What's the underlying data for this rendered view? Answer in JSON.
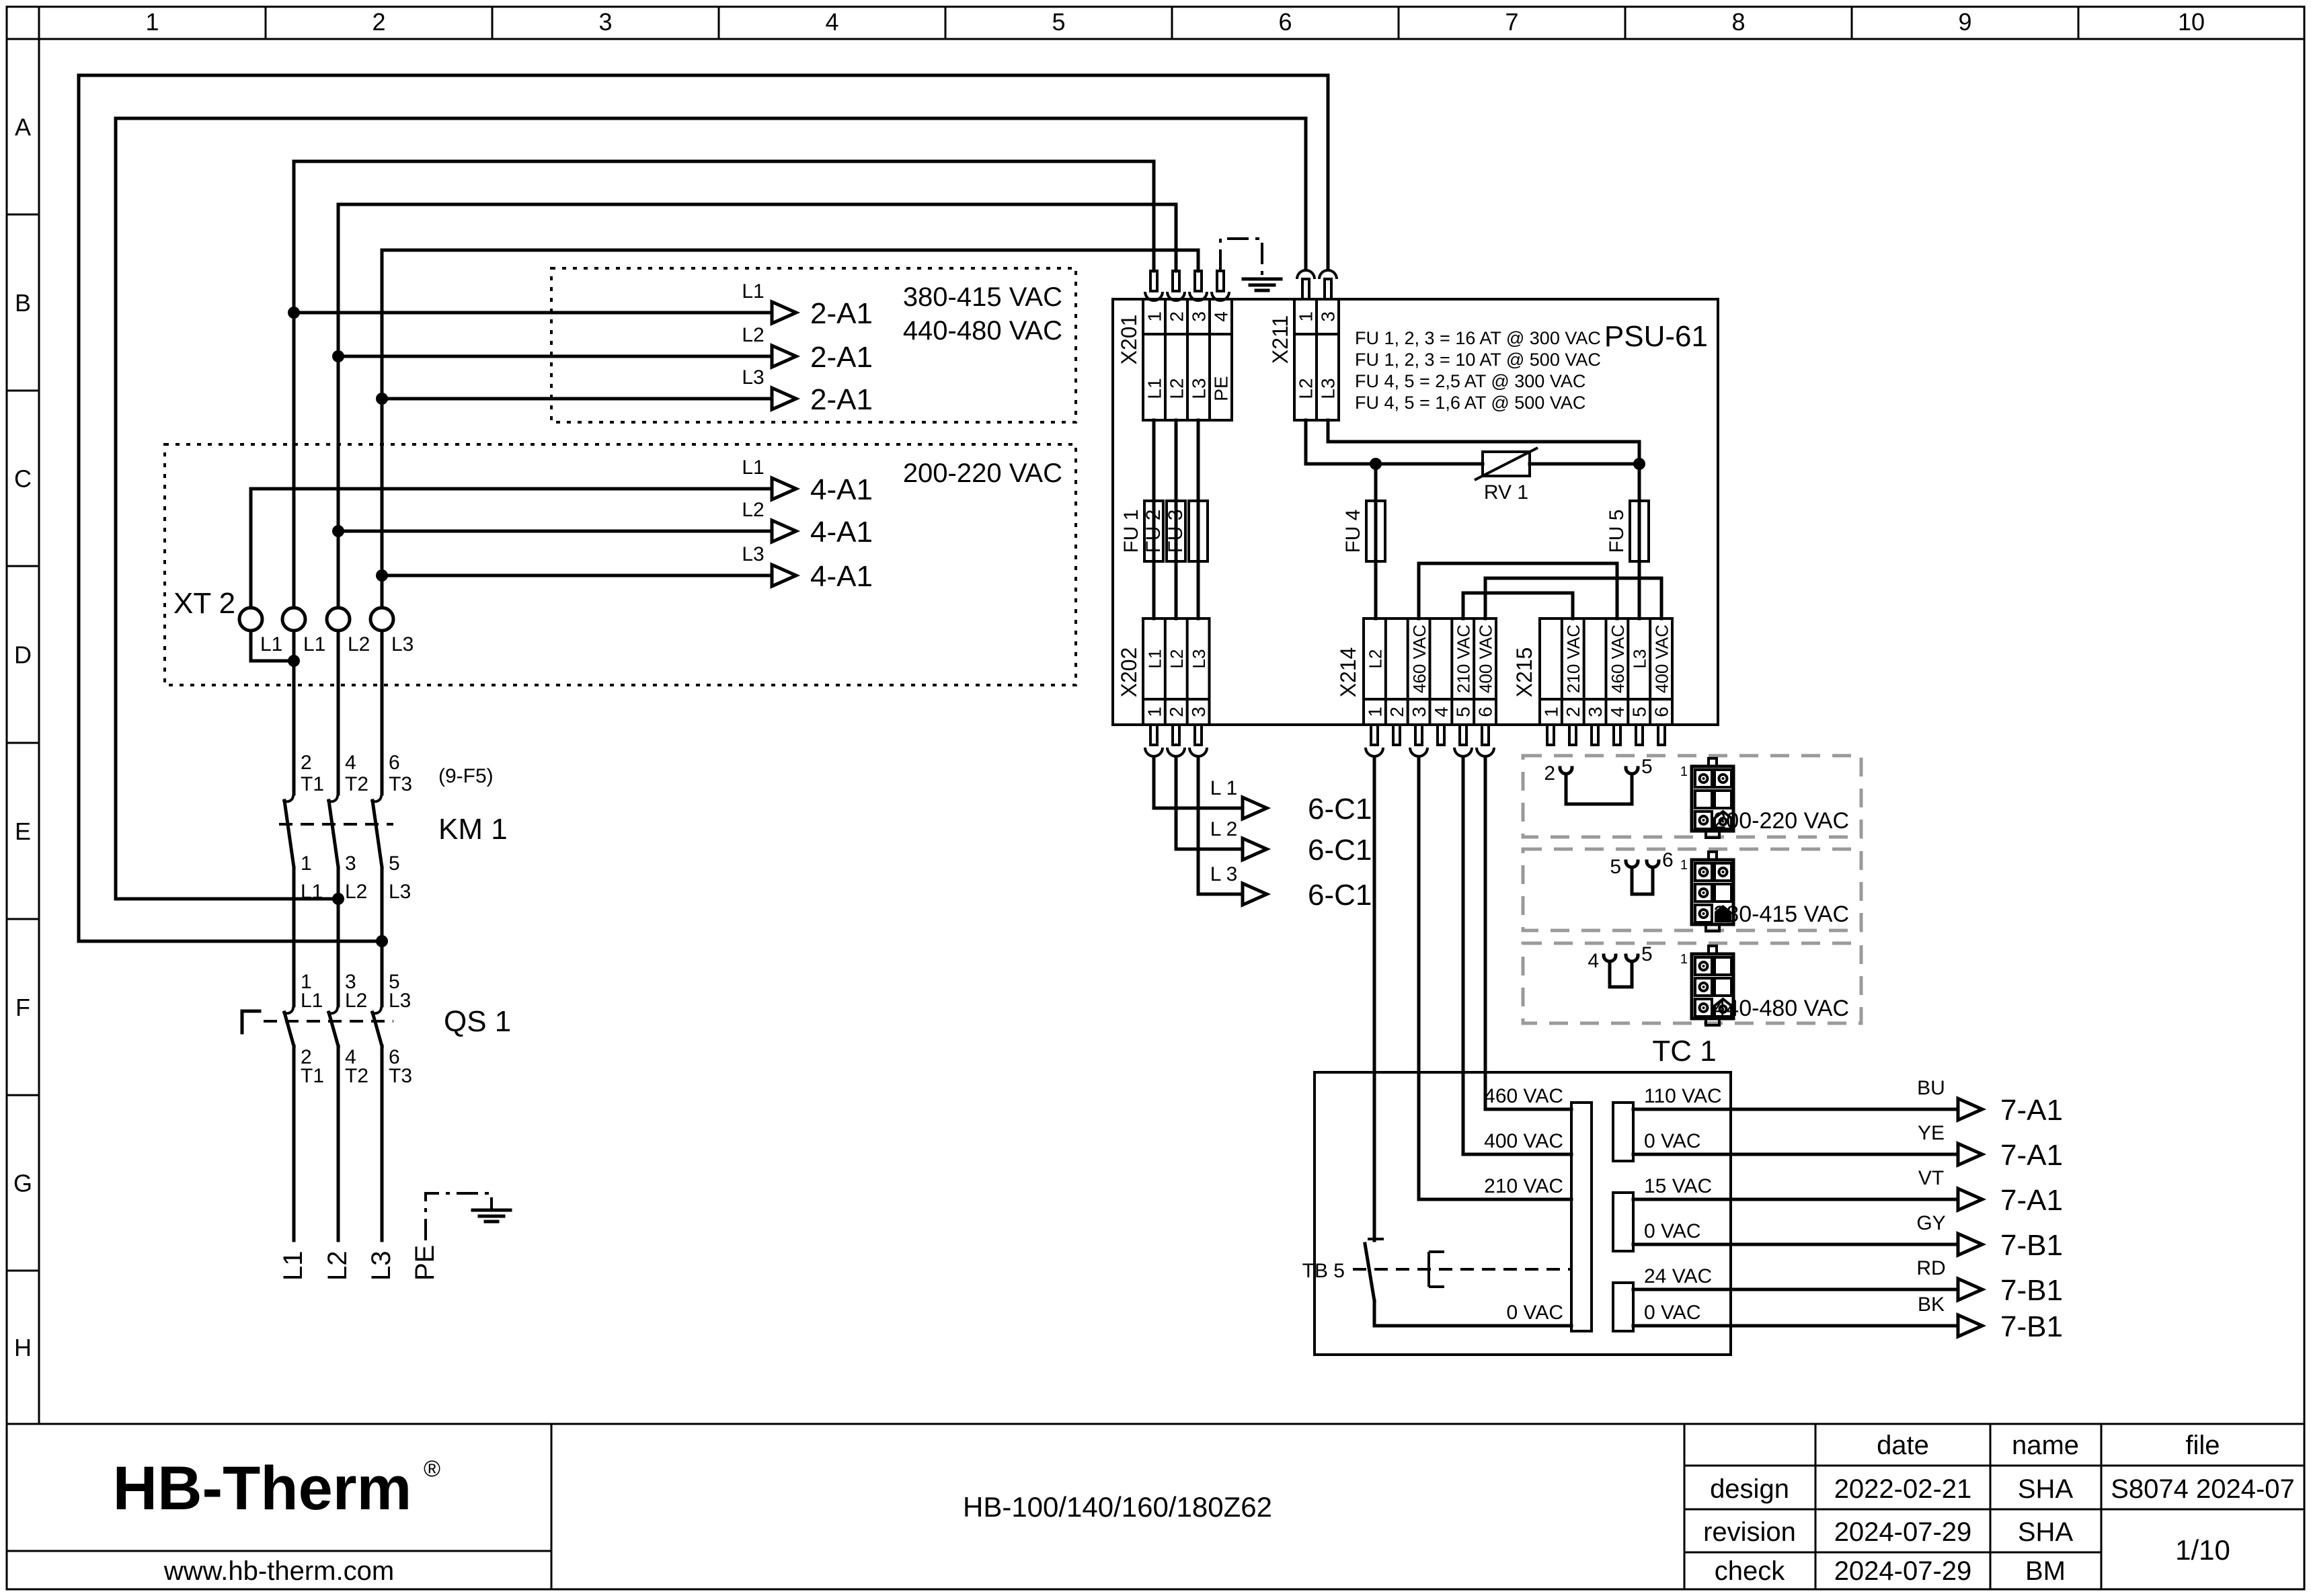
{
  "colors": {
    "line": "#000000",
    "gray_dash": "#9a9a9a",
    "logo_navy": "#1b2a5c"
  },
  "grid": {
    "columns": [
      "1",
      "2",
      "3",
      "4",
      "5",
      "6",
      "7",
      "8",
      "9",
      "10"
    ],
    "rows": [
      "A",
      "B",
      "C",
      "D",
      "E",
      "F",
      "G",
      "H"
    ]
  },
  "feeds_2a1": {
    "range1": "380-415 VAC",
    "range2": "440-480 VAC",
    "items": [
      {
        "phase": "L1",
        "target": "2-A1"
      },
      {
        "phase": "L2",
        "target": "2-A1"
      },
      {
        "phase": "L3",
        "target": "2-A1"
      }
    ]
  },
  "feeds_4a1": {
    "range": "200-220 VAC",
    "items": [
      {
        "phase": "L1",
        "target": "4-A1"
      },
      {
        "phase": "L2",
        "target": "4-A1"
      },
      {
        "phase": "L3",
        "target": "4-A1"
      }
    ]
  },
  "xt2": {
    "label": "XT 2",
    "terminals": [
      "L1",
      "L1",
      "L2",
      "L3"
    ]
  },
  "km1": {
    "label": "KM 1",
    "ref": "(9-F5)",
    "top_num": [
      "2",
      "4",
      "6"
    ],
    "top_lbl": [
      "T1",
      "T2",
      "T3"
    ],
    "bot_num": [
      "1",
      "3",
      "5"
    ],
    "bot_lbl": [
      "L1",
      "L2",
      "L3"
    ]
  },
  "qs1": {
    "label": "QS 1",
    "top_num": [
      "1",
      "3",
      "5"
    ],
    "top_lbl": [
      "L1",
      "L2",
      "L3"
    ],
    "bot_num": [
      "2",
      "4",
      "6"
    ],
    "bot_lbl": [
      "T1",
      "T2",
      "T3"
    ]
  },
  "mains": [
    "L1",
    "L2",
    "L3",
    "PE"
  ],
  "psu": {
    "label": "PSU-61",
    "notes": [
      "FU 1, 2, 3 = 16 AT @ 300 VAC",
      "FU 1, 2, 3 = 10 AT @ 500 VAC",
      "FU 4, 5 = 2,5 AT @ 300 VAC",
      "FU 4, 5 = 1,6 AT @ 500 VAC"
    ],
    "x201": {
      "label": "X201",
      "pins": [
        "1",
        "2",
        "3",
        "4"
      ],
      "wires": [
        "L1",
        "L2",
        "L3",
        "PE"
      ]
    },
    "x211": {
      "label": "X211",
      "pins": [
        "1",
        "3"
      ],
      "wires": [
        "L2",
        "L3"
      ]
    },
    "x202": {
      "label": "X202",
      "pins": [
        "1",
        "2",
        "3"
      ],
      "wires": [
        "L1",
        "L2",
        "L3"
      ]
    },
    "x214": {
      "label": "X214",
      "pins": [
        "1",
        "2",
        "3",
        "4",
        "5",
        "6"
      ],
      "wires": [
        "L2",
        "",
        "460 VAC",
        "",
        "210 VAC",
        "400 VAC"
      ]
    },
    "x215": {
      "label": "X215",
      "pins": [
        "1",
        "2",
        "3",
        "4",
        "5",
        "6"
      ],
      "wires": [
        "",
        "210 VAC",
        "",
        "460 VAC",
        "L3",
        "400 VAC"
      ]
    },
    "fuses": [
      "FU 1",
      "FU 2",
      "FU 3",
      "FU 4",
      "FU 5"
    ],
    "rv": "RV 1"
  },
  "out_6c1": {
    "items": [
      {
        "phase": "L 1",
        "target": "6-C1"
      },
      {
        "phase": "L 2",
        "target": "6-C1"
      },
      {
        "phase": "L 3",
        "target": "6-C1"
      }
    ]
  },
  "voltage_options": [
    {
      "range": "200-220 VAC",
      "jumper_pins": [
        "2",
        "5"
      ],
      "pin_label": "1",
      "cells": [
        "c",
        "c",
        "b",
        "b",
        "c",
        "h"
      ]
    },
    {
      "range": "380-415 VAC",
      "jumper_pins": [
        "5",
        "6"
      ],
      "pin_label": "1",
      "cells": [
        "c",
        "c",
        "c",
        "b",
        "c",
        "hb"
      ]
    },
    {
      "range": "440-480 VAC",
      "jumper_pins": [
        "4",
        "5"
      ],
      "pin_label": "1",
      "cells": [
        "c",
        "b",
        "c",
        "b",
        "c",
        "h"
      ]
    }
  ],
  "tc1": {
    "label": "TC 1",
    "tb": "TB 5",
    "primary": [
      "460 VAC",
      "400 VAC",
      "210 VAC",
      "0 VAC"
    ],
    "secondary": [
      "110 VAC",
      "0 VAC",
      "15 VAC",
      "0 VAC",
      "24 VAC",
      "0 VAC"
    ]
  },
  "out_7": {
    "items": [
      {
        "color": "BU",
        "target": "7-A1"
      },
      {
        "color": "YE",
        "target": "7-A1"
      },
      {
        "color": "VT",
        "target": "7-A1"
      },
      {
        "color": "GY",
        "target": "7-B1"
      },
      {
        "color": "RD",
        "target": "7-B1"
      },
      {
        "color": "BK",
        "target": "7-B1"
      }
    ]
  },
  "title_block": {
    "logo": "HB-Therm",
    "reg": "®",
    "website": "www.hb-therm.com",
    "model": "HB-100/140/160/180Z62",
    "headers": {
      "date": "date",
      "name": "name",
      "file": "file"
    },
    "rows": [
      {
        "label": "design",
        "date": "2022-02-21",
        "name": "SHA"
      },
      {
        "label": "revision",
        "date": "2024-07-29",
        "name": "SHA"
      },
      {
        "label": "check",
        "date": "2024-07-29",
        "name": "BM"
      }
    ],
    "file_no": "S8074 2024-07",
    "page": "1/10"
  }
}
